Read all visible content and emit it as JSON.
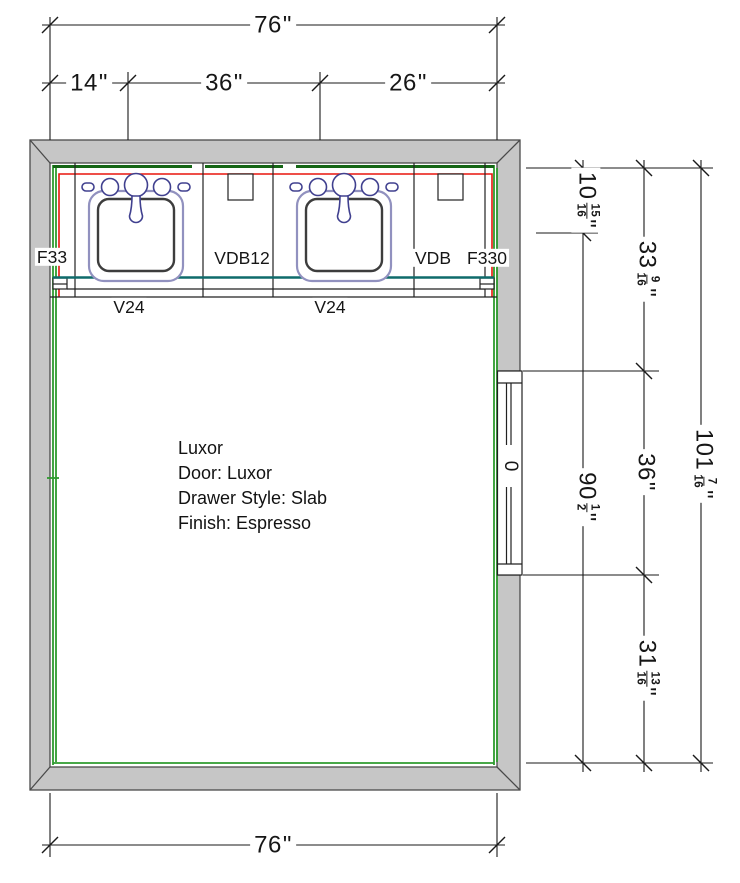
{
  "unit_mark": "\"",
  "dims": {
    "top_overall": {
      "whole": "76"
    },
    "top_left": {
      "whole": "14"
    },
    "top_mid": {
      "whole": "36"
    },
    "top_right": {
      "whole": "26"
    },
    "bottom_overall": {
      "whole": "76"
    },
    "right_c1_top": {
      "whole": "10",
      "num": "15",
      "den": "16"
    },
    "right_c1_bottom": {
      "whole": "90",
      "num": "1",
      "den": "2"
    },
    "right_c2_top": {
      "whole": "33",
      "num": "9",
      "den": "16"
    },
    "right_c2_mid": {
      "whole": "36"
    },
    "right_c2_bottom": {
      "whole": "31",
      "num": "13",
      "den": "16"
    },
    "right_overall": {
      "whole": "101",
      "num": "7",
      "den": "16"
    }
  },
  "cabinet_labels": {
    "left_filler": "F33",
    "left_drawer_base": "VDB12",
    "right_drawer_base": "VDB",
    "right_filler": "F330",
    "vanity_left": "V24",
    "vanity_right": "V24"
  },
  "door": {
    "label": "0"
  },
  "annotation": {
    "lines": [
      "Luxor",
      "Door: Luxor",
      "Drawer Style: Slab",
      "Finish: Espresso"
    ]
  },
  "colors": {
    "wall_fill": "#c6c6c6",
    "wall_edge": "#4a4a4a",
    "liner_green": "#2e9b2e",
    "backsplash_green": "#156615",
    "counter_red": "#e8150d",
    "counter_teal": "#0f6b6b",
    "sink_rim": "#9191bf",
    "sink_bowl": "#3d3d3d",
    "faucet_navy": "#40408f",
    "dim_line": "#1a1a1a"
  }
}
